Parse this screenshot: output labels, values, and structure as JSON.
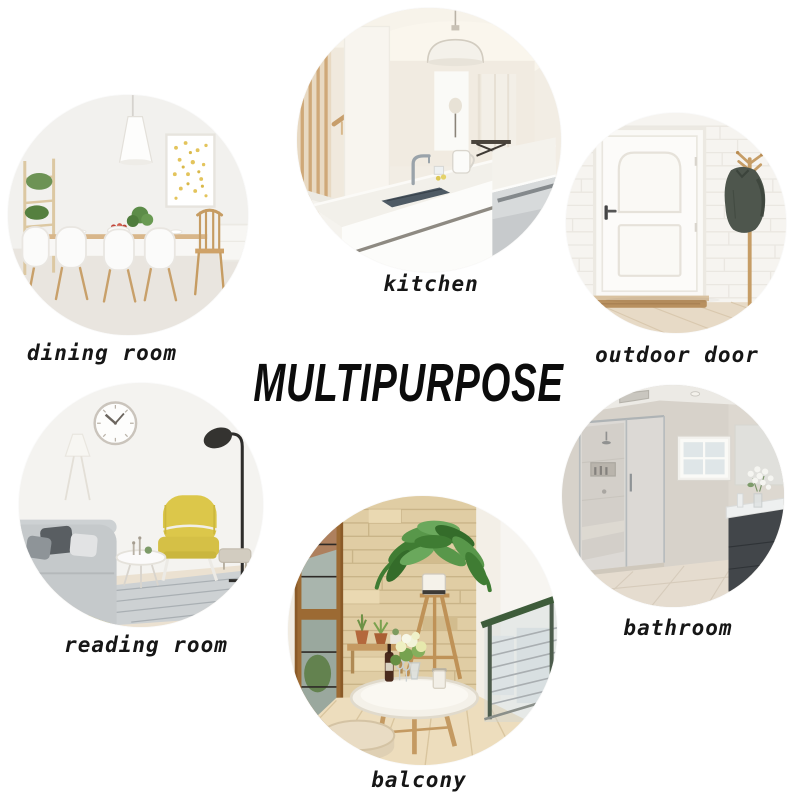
{
  "title": "MULTIPURPOSE",
  "photos": [
    {
      "id": "dining-room",
      "label": "dining room"
    },
    {
      "id": "kitchen",
      "label": "kitchen"
    },
    {
      "id": "outdoor-door",
      "label": "outdoor door"
    },
    {
      "id": "reading-room",
      "label": "reading room"
    },
    {
      "id": "bathroom",
      "label": "bathroom"
    },
    {
      "id": "balcony",
      "label": "balcony"
    }
  ],
  "colors": {
    "background": "#ffffff",
    "label_text": "#161616",
    "title_text": "#0c0c0c",
    "accent_yellow_chair": "#dcc74a",
    "plant_green": "#4f8a3c",
    "wood_tone": "#c49a62",
    "stone_wall": "#e0cda4",
    "jacket_dark": "#4e564d"
  }
}
